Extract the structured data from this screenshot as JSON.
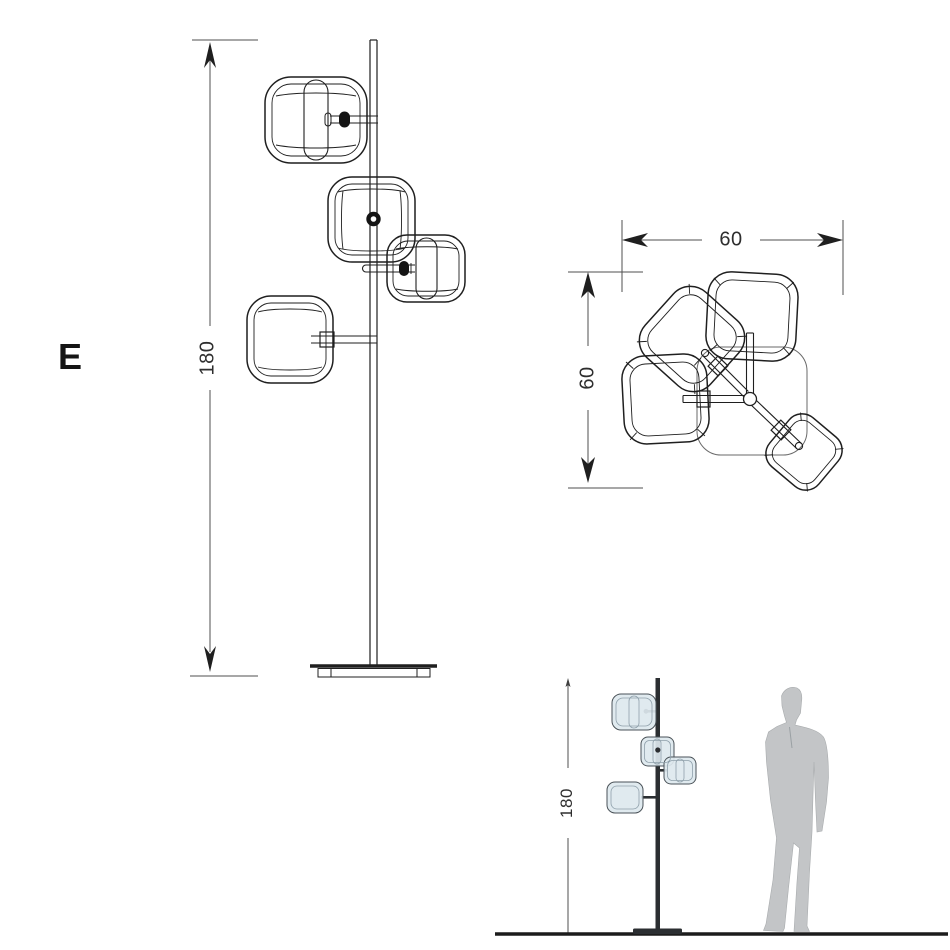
{
  "figure": {
    "variant_label": "E",
    "front_view": {
      "height_label": "180"
    },
    "top_view": {
      "width_label": "60",
      "depth_label": "60"
    },
    "scale_view": {
      "height_label": "180"
    }
  },
  "colors": {
    "background": "#ffffff",
    "artwork_line": "#1f1f1f",
    "dimension_line": "#4f4f4f",
    "plate_outline": "#6a6a6a",
    "silhouette_fill": "#c3c5c7",
    "pole_dark": "#2b2e31",
    "shade_fill": "#dde8ee",
    "shade_stroke": "#4a5258",
    "floor_line": "#1c1c1c"
  }
}
